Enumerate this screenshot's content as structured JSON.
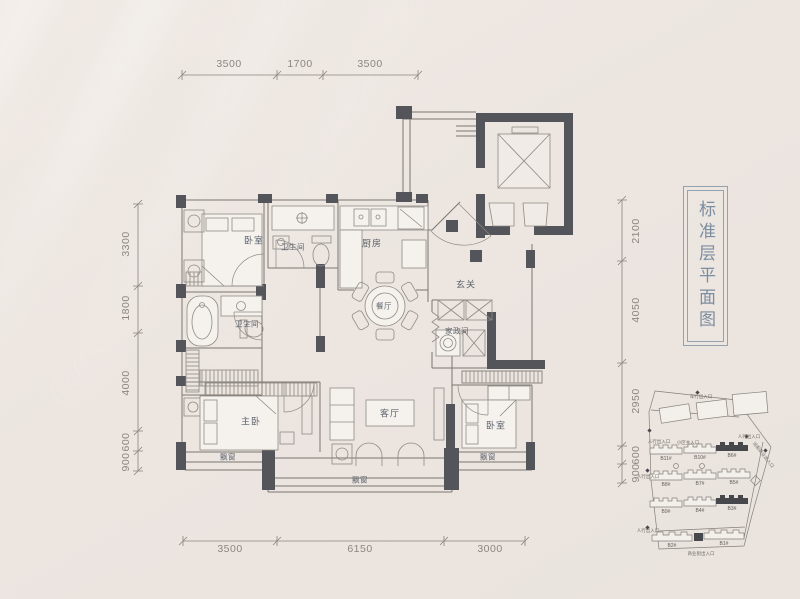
{
  "title": {
    "text": "标准层平面图"
  },
  "rooms": {
    "bedroom_top": "卧室",
    "bathroom_top": "卫生间",
    "kitchen": "厨房",
    "foyer": "玄关",
    "dining": "餐厅",
    "bathroom_main": "卫生间",
    "housekeeping": "家政间",
    "master_bedroom": "主卧",
    "living_room": "客厅",
    "bedroom_right": "卧室",
    "bay_window_master": "飘窗",
    "bay_window_living": "飘窗",
    "bay_window_right": "飘窗"
  },
  "dimensions": {
    "top": [
      "3500",
      "1700",
      "3500"
    ],
    "bottom": [
      "3500",
      "6150",
      "3000"
    ],
    "left": [
      "3300",
      "1800",
      "4000",
      "600",
      "900"
    ],
    "right": [
      "2100",
      "4050",
      "2950",
      "600",
      "900"
    ]
  },
  "site_map": {
    "buildings": [
      {
        "label": "B11#",
        "highlighted": false
      },
      {
        "label": "B10#",
        "highlighted": false
      },
      {
        "label": "B6#",
        "highlighted": true
      },
      {
        "label": "B8#",
        "highlighted": false
      },
      {
        "label": "B7#",
        "highlighted": false
      },
      {
        "label": "B5#",
        "highlighted": false
      },
      {
        "label": "B9#",
        "highlighted": false
      },
      {
        "label": "B4#",
        "highlighted": false
      },
      {
        "label": "B3#",
        "highlighted": true
      },
      {
        "label": "B2#",
        "highlighted": false
      },
      {
        "label": "B1#",
        "highlighted": false
      }
    ],
    "entrances": {
      "top": "车行出入口",
      "main": "小区主入口",
      "left_upper": "人行出入口",
      "right_upper": "人行出入口",
      "left_mid": "人行出入口",
      "left_lower": "人行出入口",
      "bottom": "商业街出入口",
      "street": "沿街商业出入口"
    }
  },
  "colors": {
    "background": "#ece5e0",
    "wall": "#54555a",
    "line": "#7b766f",
    "accent": "#7b8da0",
    "dim_text": "#8b8680",
    "room_text": "#5d646d"
  }
}
